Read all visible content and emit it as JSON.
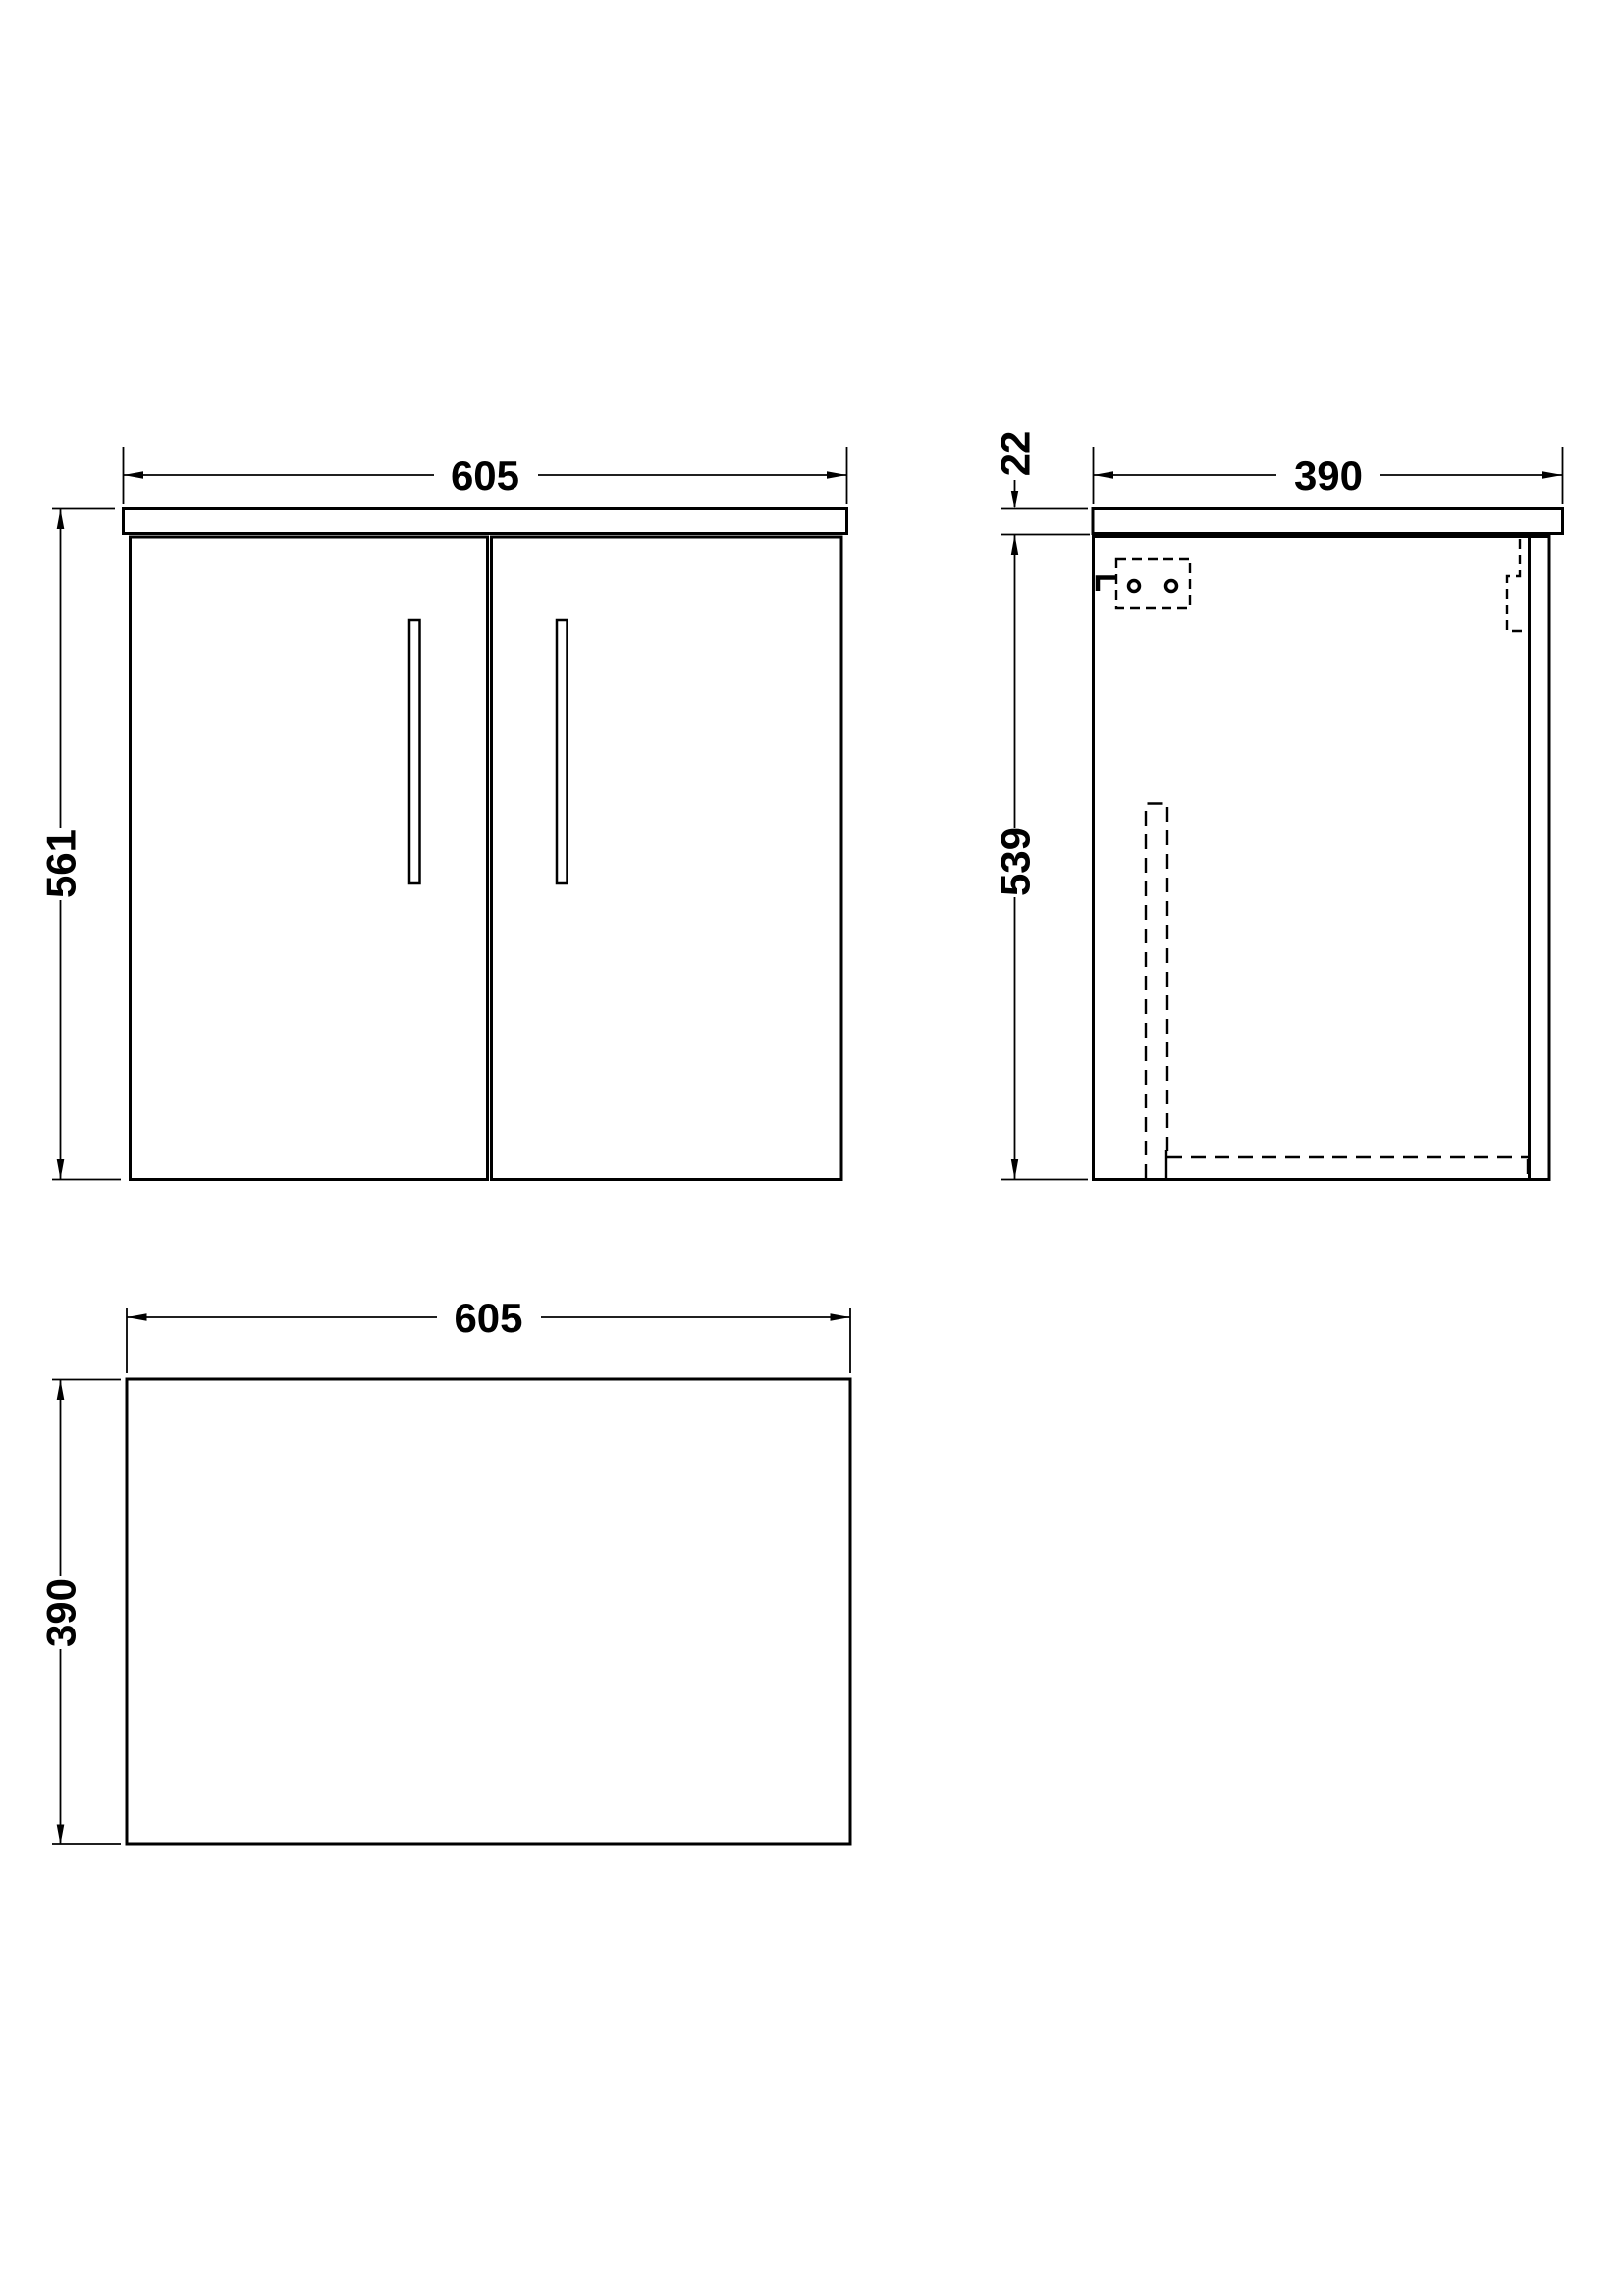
{
  "canvas": {
    "background": "#ffffff",
    "line_color": "#000000"
  },
  "front_view": {
    "width_mm": "605",
    "overall_height_mm": "561"
  },
  "side_view": {
    "depth_mm": "390",
    "countertop_thickness_mm": "22",
    "body_height_mm": "539"
  },
  "plan_view": {
    "width_mm": "605",
    "depth_mm": "390"
  }
}
